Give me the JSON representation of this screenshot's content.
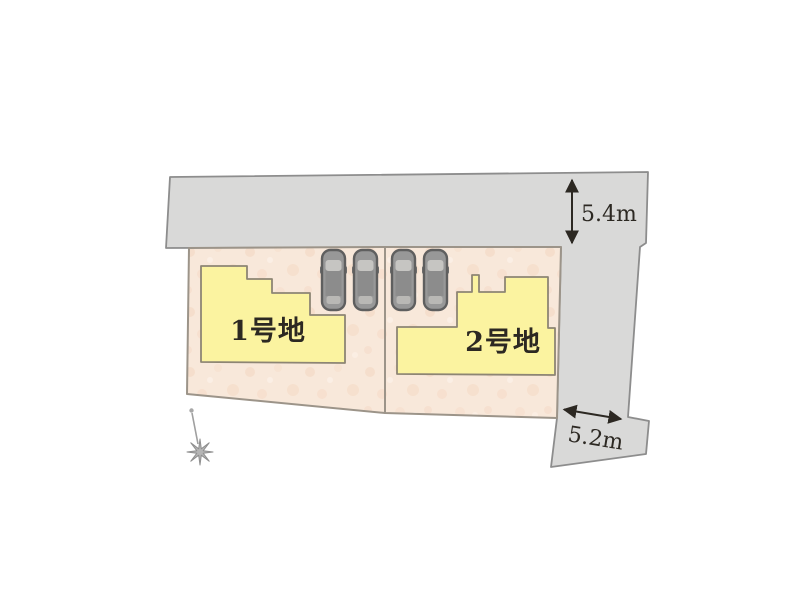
{
  "plots": [
    {
      "id": 1,
      "label": "1号地"
    },
    {
      "id": 2,
      "label": "2号地"
    }
  ],
  "dimensions": {
    "top_road_width": "5.4m",
    "side_road_width": "5.2m"
  },
  "vehicles": {
    "car_count": 4
  },
  "icons": [
    "car-icon",
    "compass-star-icon",
    "dimension-arrow-icon"
  ],
  "colors": {
    "road_fill": "#d9d9d8",
    "road_border": "#8d8d8d",
    "plot_fill": "#f8e8da",
    "plot_texture": "#f2d2bb",
    "plot_border": "#9c9489",
    "building_fill": "#fbf3a0",
    "building_border": "#8d8574",
    "car_body": "#989898",
    "car_outline": "#5f5f5f",
    "car_window": "#c6c5c2",
    "text_and_arrows": "#2c2822"
  }
}
